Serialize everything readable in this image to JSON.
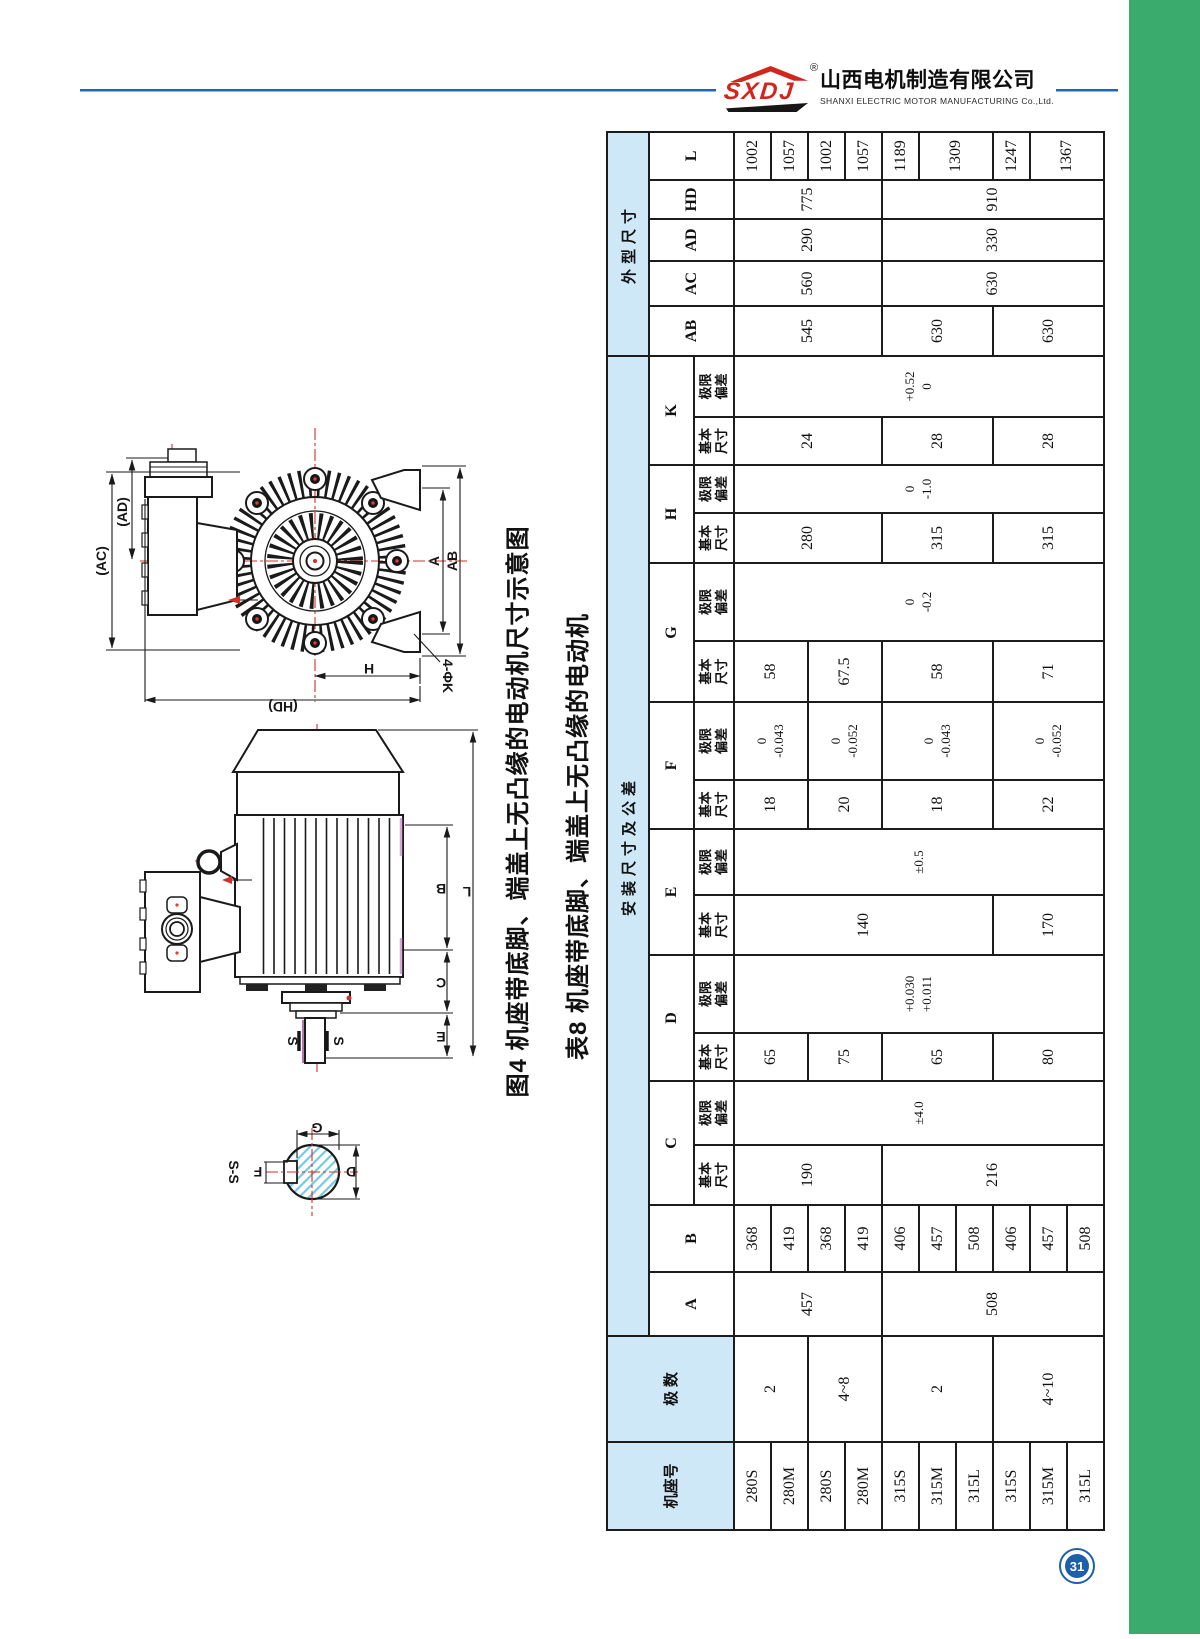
{
  "page": {
    "number": "31"
  },
  "header": {
    "logo": "SXDJ",
    "registered": "®",
    "company_cn": "山西电机制造有限公司",
    "company_en": "SHANXI ELECTRIC MOTOR MANUFACTURING Co.,Ltd."
  },
  "figure": {
    "caption": "图4 机座带底脚、端盖上无凸缘的电动机尺寸示意图",
    "section_label": "S-S",
    "dims": {
      "AC": "(AC)",
      "AD": "(AD)",
      "AB": "AB",
      "A": "A",
      "H": "H",
      "HD": "(HD)",
      "K4": "4-ΦK",
      "B": "B",
      "C": "C",
      "E": "E",
      "L": "L",
      "S1": "S",
      "S2": "S",
      "G": "G",
      "F": "F",
      "D": "D"
    }
  },
  "table": {
    "title": "表8 机座带底脚、端盖上无凸缘的电动机",
    "h": {
      "frame": "机座号",
      "poles": "极 数",
      "install": "安装尺寸及公差",
      "outline": "外型尺寸",
      "basic": "基本\n尺寸",
      "limit": "极限\n偏差",
      "A": "A",
      "B": "B",
      "C": "C",
      "D": "D",
      "E": "E",
      "F": "F",
      "G": "G",
      "H": "H",
      "K": "K",
      "AB": "AB",
      "AC": "AC",
      "AD": "AD",
      "HD": "HD",
      "L": "L"
    },
    "frames": [
      "280S",
      "280M",
      "280S",
      "280M",
      "315S",
      "315M",
      "315L",
      "315S",
      "315M",
      "315L"
    ],
    "poles": [
      "2",
      "4~8",
      "2",
      "4~10"
    ],
    "A": [
      "457",
      "508"
    ],
    "B": [
      "368",
      "419",
      "368",
      "419",
      "406",
      "457",
      "508",
      "406",
      "457",
      "508"
    ],
    "Cb": [
      "190",
      "216"
    ],
    "Ct": "±4.0",
    "Db": [
      "65",
      "75",
      "65",
      "80"
    ],
    "Dt": "+0.030\n+0.011",
    "Eb": [
      "140",
      "170"
    ],
    "Et": "±0.5",
    "Fb": [
      "18",
      "20",
      "18",
      "22"
    ],
    "Ft": [
      "0\n-0.043",
      "0\n-0.052",
      "0\n-0.043",
      "0\n-0.052"
    ],
    "Gb": [
      "58",
      "67.5",
      "58",
      "71"
    ],
    "Gt": "0\n-0.2",
    "Hb": [
      "280",
      "315",
      "315"
    ],
    "Ht": "0\n-1.0",
    "Kb": [
      "24",
      "28",
      "28"
    ],
    "Kt": "+0.52\n0",
    "AB": [
      "545",
      "630",
      "630"
    ],
    "AC": [
      "560",
      "630"
    ],
    "AD": [
      "290",
      "330"
    ],
    "HD": [
      "775",
      "910"
    ],
    "L": [
      "1002",
      "1057",
      "1002",
      "1057",
      "1189",
      "1309",
      "1247",
      "1367"
    ]
  }
}
